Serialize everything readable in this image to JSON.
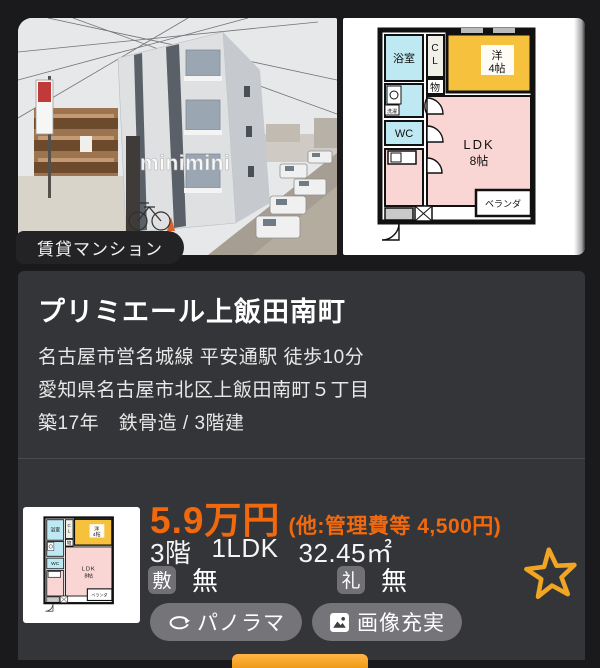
{
  "page": {
    "bg": "#1A1A1C",
    "panel_bg": "#343538",
    "accent_orange": "#F2690D",
    "star_color": "#F0A622"
  },
  "listing": {
    "category_badge": "賃貸マンション",
    "title": "プリミエール上飯田南町",
    "access": "名古屋市営名城線 平安通駅 徒歩10分",
    "address": "愛知県名古屋市北区上飯田南町５丁目",
    "building": "築17年　鉄骨造 / 3階建",
    "price": {
      "rent": "5.9万円",
      "extra": "(他:管理費等 4,500円)"
    },
    "specs": {
      "floor": "3階",
      "layout": "1LDK",
      "area": "32.45㎡"
    },
    "deposit": {
      "label": "敷",
      "value": "無"
    },
    "key_money": {
      "label": "礼",
      "value": "無"
    },
    "buttons": {
      "panorama": "パノラマ",
      "images": "画像充実"
    }
  },
  "photo": {
    "watermark": "minimini"
  },
  "floorplan": {
    "bath": "浴室",
    "closet_top": "C",
    "closet_bottom": "L",
    "western_l1": "洋",
    "western_l2": "4帖",
    "storage": "物",
    "laundry": "洗濯",
    "wc": "WC",
    "ldk_l1": "LDK",
    "ldk_l2": "8帖",
    "veranda": "ベランダ"
  },
  "icons": {
    "panorama": "rotate-360-icon",
    "images": "image-icon",
    "favorite": "star-outline-icon"
  }
}
